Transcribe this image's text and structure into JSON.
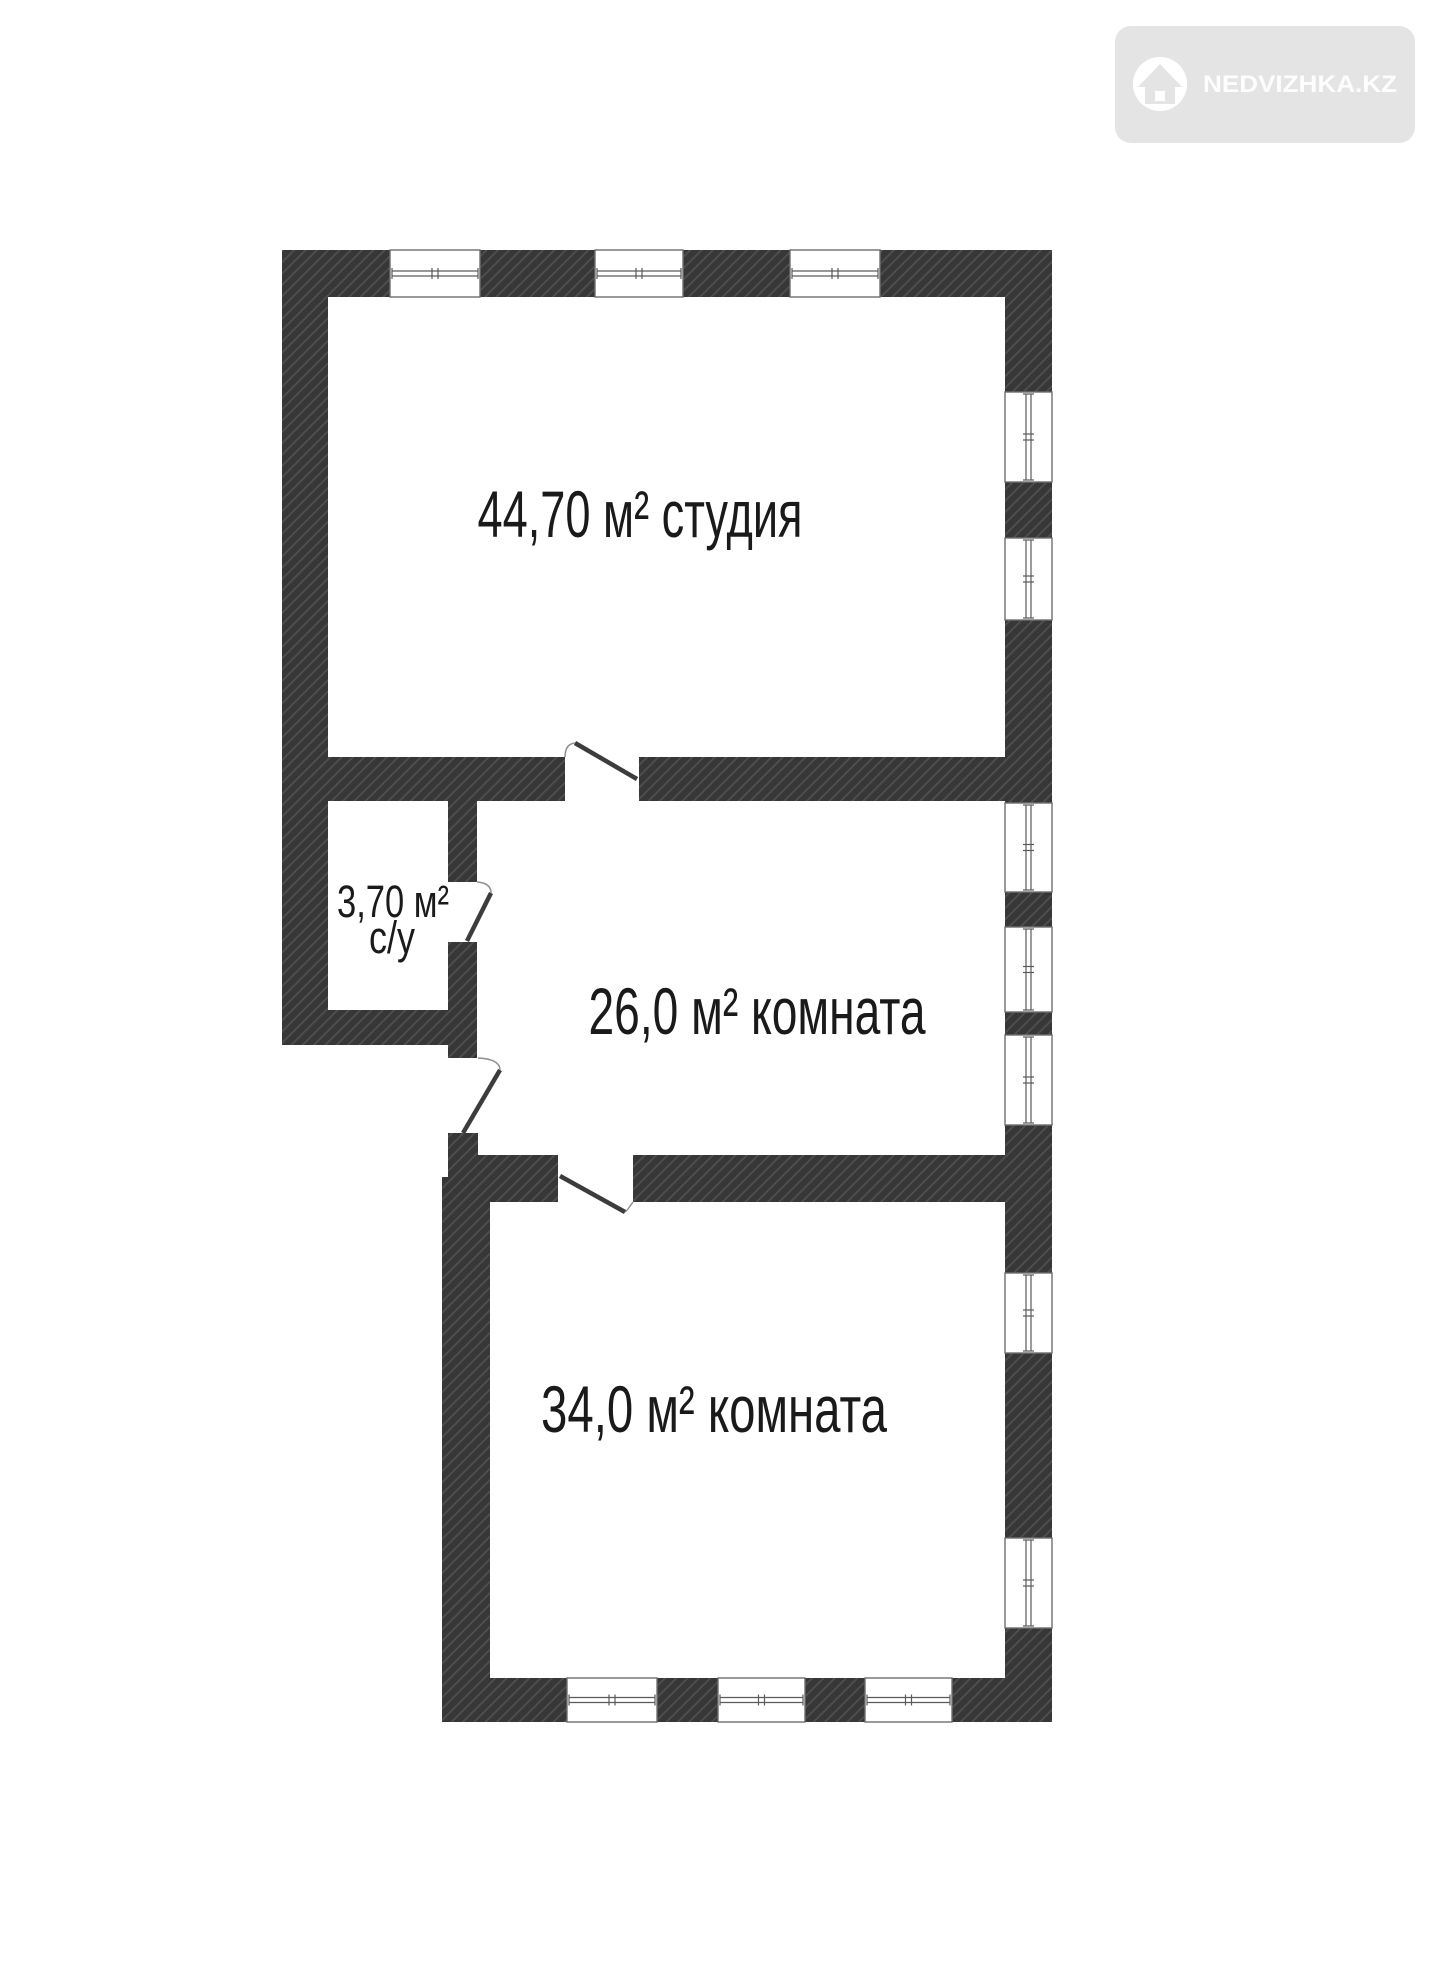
{
  "watermark": {
    "brand": "NEDVIZHKA.KZ",
    "icon": "house-icon",
    "badge_color": "#e4e4e4",
    "text_color": "#fdfdfd"
  },
  "plan": {
    "background": "#ffffff",
    "wall_color": "#373737",
    "hatch_line_color": "#4f4f4f",
    "label_color": "#1a1a1a",
    "rooms": {
      "studio": {
        "label": "44,70 м² студия",
        "area_m2": "44,70"
      },
      "bathroom": {
        "area_label": "3,70 м²",
        "type_label": "с/у",
        "area_m2": "3,70"
      },
      "room26": {
        "label": "26,0 м² комната",
        "area_m2": "26,0"
      },
      "room34": {
        "label": "34,0 м²  комната",
        "area_m2": "34,0"
      }
    }
  }
}
